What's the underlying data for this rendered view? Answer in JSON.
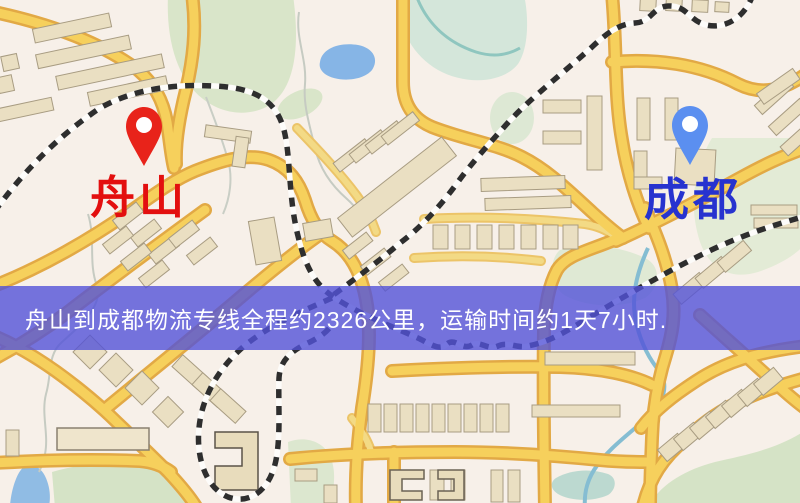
{
  "map": {
    "origin": {
      "name": "舟山",
      "pin_color": "#e8231a",
      "label_color": "#e30f0f"
    },
    "destination": {
      "name": "成都",
      "pin_color": "#5b8ff0",
      "label_color": "#2733cf"
    },
    "banner": {
      "text": "舟山到成都物流专线全程约2326公里，运输时间约1天7小时.",
      "bg_color": "#5252d8",
      "text_color": "#ffffff"
    },
    "map_colors": {
      "background": "#f7f0e9",
      "road": "#f6d05c",
      "road_casing": "#e2a945",
      "railway": "#2e2e2e",
      "water": "#86b5e6",
      "park": "#d9e5c9",
      "building": "#eadfc2"
    }
  }
}
